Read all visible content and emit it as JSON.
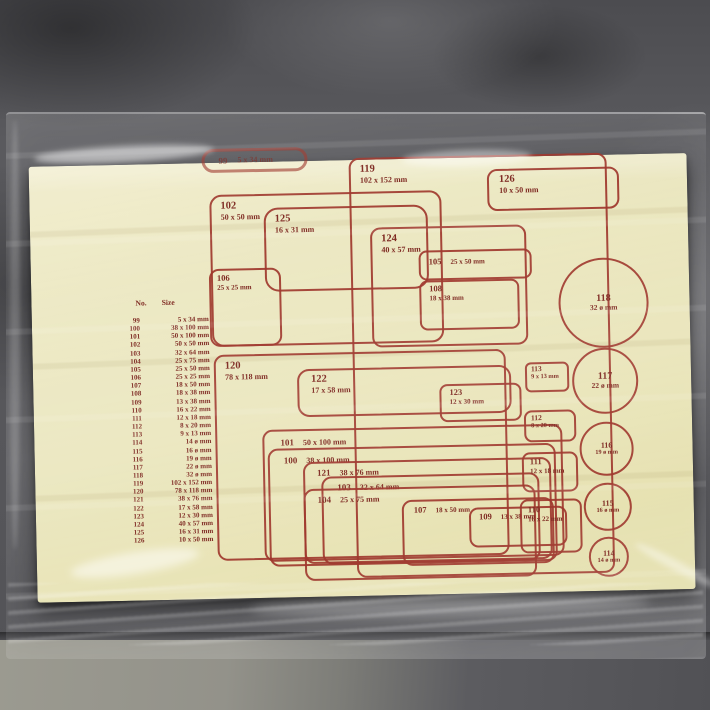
{
  "photo": {
    "description": "Yellow self-adhesive label size template sheet inside a clear plastic bag on grey stone floor",
    "colors": {
      "paper": "#eae6bc",
      "ink": "#8f2b20",
      "stone": "#58585c",
      "bag_highlight": "#ffffff"
    }
  },
  "table": {
    "headers": {
      "no": "No.",
      "size": "Size"
    },
    "rows": [
      {
        "no": "99",
        "size": "5 x 34 mm"
      },
      {
        "no": "100",
        "size": "38 x 100 mm"
      },
      {
        "no": "101",
        "size": "50 x 100 mm"
      },
      {
        "no": "102",
        "size": "50 x 50 mm"
      },
      {
        "no": "103",
        "size": "32 x 64 mm"
      },
      {
        "no": "104",
        "size": "25 x 75 mm"
      },
      {
        "no": "105",
        "size": "25 x 50 mm"
      },
      {
        "no": "106",
        "size": "25 x 25 mm"
      },
      {
        "no": "107",
        "size": "18 x 50 mm"
      },
      {
        "no": "108",
        "size": "18 x 38 mm"
      },
      {
        "no": "109",
        "size": "13 x 38 mm"
      },
      {
        "no": "110",
        "size": "16 x 22 mm"
      },
      {
        "no": "111",
        "size": "12 x 18 mm"
      },
      {
        "no": "112",
        "size": "8 x 20 mm"
      },
      {
        "no": "113",
        "size": "9 x 13 mm"
      },
      {
        "no": "114",
        "size": "14 ø mm"
      },
      {
        "no": "115",
        "size": "16 ø mm"
      },
      {
        "no": "116",
        "size": "19 ø mm"
      },
      {
        "no": "117",
        "size": "22 ø mm"
      },
      {
        "no": "118",
        "size": "32 ø mm"
      },
      {
        "no": "119",
        "size": "102 x 152 mm"
      },
      {
        "no": "120",
        "size": "78 x 118 mm"
      },
      {
        "no": "121",
        "size": "38 x 76 mm"
      },
      {
        "no": "122",
        "size": "17 x 58 mm"
      },
      {
        "no": "123",
        "size": "12 x 30 mm"
      },
      {
        "no": "124",
        "size": "40 x 57 mm"
      },
      {
        "no": "125",
        "size": "16 x 31 mm"
      },
      {
        "no": "126",
        "size": "10 x 50 mm"
      }
    ]
  },
  "shapes": {
    "n99": {
      "no": "99",
      "size": "5 x 34 mm"
    },
    "n100": {
      "no": "100",
      "size": "38 x 100 mm"
    },
    "n101": {
      "no": "101",
      "size": "50 x 100 mm"
    },
    "n102": {
      "no": "102",
      "size": "50 x 50 mm"
    },
    "n103": {
      "no": "103",
      "size": "32 x 64 mm"
    },
    "n104": {
      "no": "104",
      "size": "25 x 75 mm"
    },
    "n105": {
      "no": "105",
      "size": "25 x 50 mm"
    },
    "n106": {
      "no": "106",
      "size": "25 x 25 mm"
    },
    "n107": {
      "no": "107",
      "size": "18 x 50 mm"
    },
    "n108": {
      "no": "108",
      "size": "18 x 38 mm"
    },
    "n109": {
      "no": "109",
      "size": "13 x 38 mm"
    },
    "n110": {
      "no": "110",
      "size": "16 x 22 mm"
    },
    "n111": {
      "no": "111",
      "size": "12 x 18 mm"
    },
    "n112": {
      "no": "112",
      "size": "8 x 20 mm"
    },
    "n113": {
      "no": "113",
      "size": "9 x 13 mm"
    },
    "n114": {
      "no": "114",
      "size": "14 ø mm"
    },
    "n115": {
      "no": "115",
      "size": "16 ø mm"
    },
    "n116": {
      "no": "116",
      "size": "19 ø mm"
    },
    "n117": {
      "no": "117",
      "size": "22 ø mm"
    },
    "n118": {
      "no": "118",
      "size": "32 ø mm"
    },
    "n119": {
      "no": "119",
      "size": "102 x 152 mm"
    },
    "n120": {
      "no": "120",
      "size": "78 x 118 mm"
    },
    "n121": {
      "no": "121",
      "size": "38 x 76 mm"
    },
    "n122": {
      "no": "122",
      "size": "17 x 58 mm"
    },
    "n123": {
      "no": "123",
      "size": "12 x 30 mm"
    },
    "n124": {
      "no": "124",
      "size": "40 x 57 mm"
    },
    "n125": {
      "no": "125",
      "size": "16 x 31 mm"
    },
    "n126": {
      "no": "126",
      "size": "10 x 50 mm"
    }
  }
}
